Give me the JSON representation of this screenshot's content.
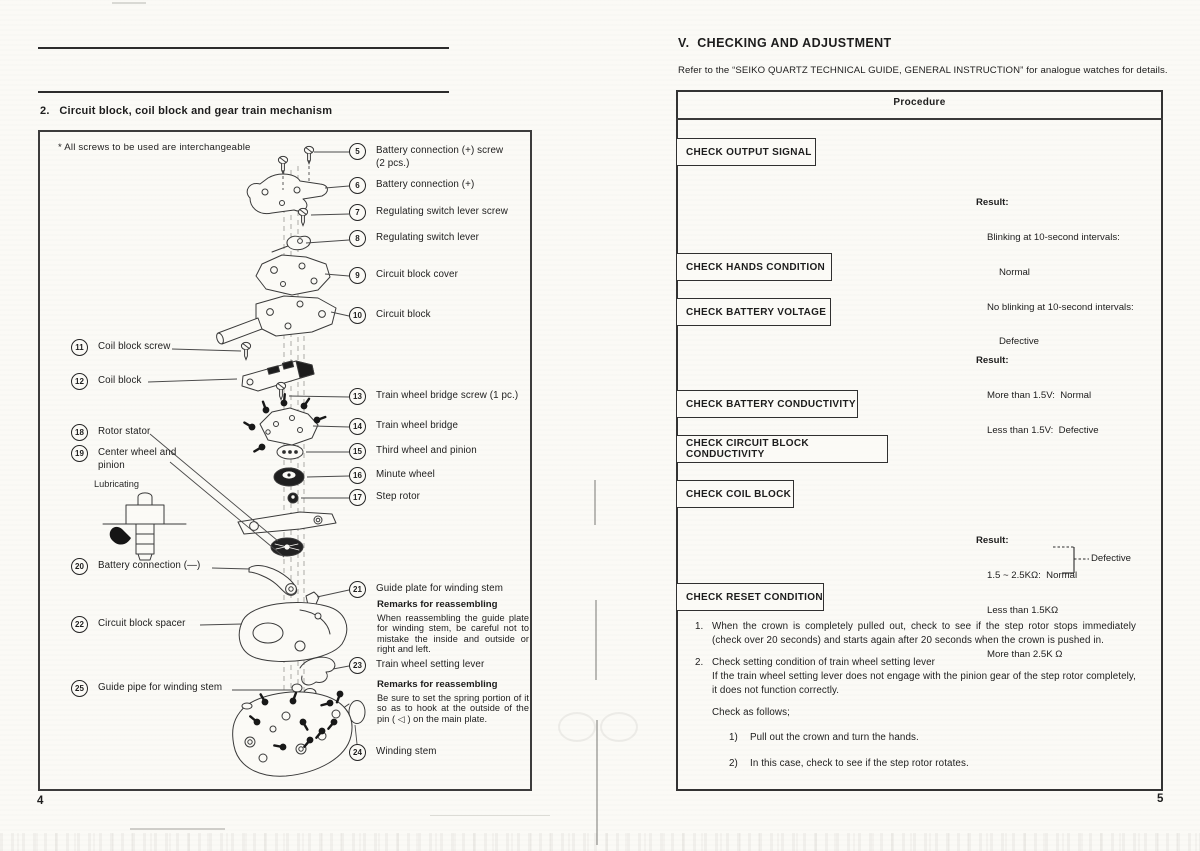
{
  "left_page": {
    "heading": "2.   Circuit block, coil block and gear train mechanism",
    "note": "* All screws to be used are interchangeable",
    "lubricating": "Lubricating",
    "page_number": "4",
    "parts": {
      "5": {
        "num": "5",
        "label": "Battery connection (+) screw",
        "label2": "(2 pcs.)"
      },
      "6": {
        "num": "6",
        "label": "Battery connection (+)"
      },
      "7": {
        "num": "7",
        "label": "Regulating switch lever screw"
      },
      "8": {
        "num": "8",
        "label": "Regulating switch lever"
      },
      "9": {
        "num": "9",
        "label": "Circuit block cover"
      },
      "10": {
        "num": "10",
        "label": "Circuit block"
      },
      "11": {
        "num": "11",
        "label": "Coil block screw"
      },
      "12": {
        "num": "12",
        "label": "Coil block"
      },
      "13": {
        "num": "13",
        "label": "Train wheel bridge screw (1 pc.)"
      },
      "14": {
        "num": "14",
        "label": "Train wheel bridge"
      },
      "15": {
        "num": "15",
        "label": "Third wheel and pinion"
      },
      "16": {
        "num": "16",
        "label": "Minute wheel"
      },
      "17": {
        "num": "17",
        "label": "Step rotor"
      },
      "18": {
        "num": "18",
        "label": "Rotor stator"
      },
      "19": {
        "num": "19",
        "label": "Center wheel and",
        "label2": "pinion"
      },
      "20": {
        "num": "20",
        "label": "Battery connection (—)"
      },
      "21": {
        "num": "21",
        "label": "Guide plate for winding stem"
      },
      "22": {
        "num": "22",
        "label": "Circuit block spacer"
      },
      "23": {
        "num": "23",
        "label": "Train wheel setting lever"
      },
      "24": {
        "num": "24",
        "label": "Winding stem"
      },
      "25": {
        "num": "25",
        "label": "Guide pipe for winding stem"
      }
    },
    "remarks_guide_plate": {
      "title": "Remarks for reassembling",
      "body": "When reassembling the guide plate for winding stem, be careful not to mistake the inside and outside or right and left."
    },
    "remarks_setting_lever": {
      "title": "Remarks for reassembling",
      "body": "Be sure to set the spring portion of it so as to hook at the outside of the pin ( ◁ ) on the main plate."
    }
  },
  "right_page": {
    "title": "V.  CHECKING AND ADJUSTMENT",
    "subtitle": "Refer to the “SEIKO QUARTZ TECHNICAL GUIDE, GENERAL INSTRUCTION” for analogue watches for details.",
    "table_header": "Procedure",
    "checks": [
      "CHECK OUTPUT SIGNAL",
      "CHECK HANDS CONDITION",
      "CHECK BATTERY VOLTAGE",
      "CHECK BATTERY CONDUCTIVITY",
      "CHECK CIRCUIT BLOCK CONDUCTIVITY",
      "CHECK COIL BLOCK",
      "CHECK RESET CONDITION"
    ],
    "result_output_signal": {
      "title": "Result:",
      "line1": "Blinking at 10-second intervals:",
      "line2": "Normal",
      "line3": "No blinking at 10-second intervals:",
      "line4": "Defective"
    },
    "result_battery_voltage": {
      "title": "Result:",
      "line1": "More than 1.5V:  Normal",
      "line2": "Less than 1.5V:  Defective"
    },
    "result_coil_block": {
      "title": "Result:",
      "line1": "1.5 ~ 2.5KΩ:  Normal",
      "line2": "Less than 1.5KΩ",
      "line3": "More than 2.5K Ω",
      "branch": "Defective"
    },
    "notes": {
      "n1_num": "1.",
      "n1": "When the crown is completely pulled out, check to see if the step rotor stops immediately (check over 20 seconds) and starts again after 20 seconds when the crown is pushed in.",
      "n2_num": "2.",
      "n2a": "Check setting condition of train wheel setting lever",
      "n2b": "If the train wheel setting lever does not engage with the pinion gear of the step rotor completely, it does not function correctly.",
      "check_as": "Check as follows;",
      "s1_num": "1)",
      "s1": "Pull out the crown and turn the hands.",
      "s2_num": "2)",
      "s2": "In this case, check to see if the step rotor rotates."
    },
    "page_number": "5"
  }
}
